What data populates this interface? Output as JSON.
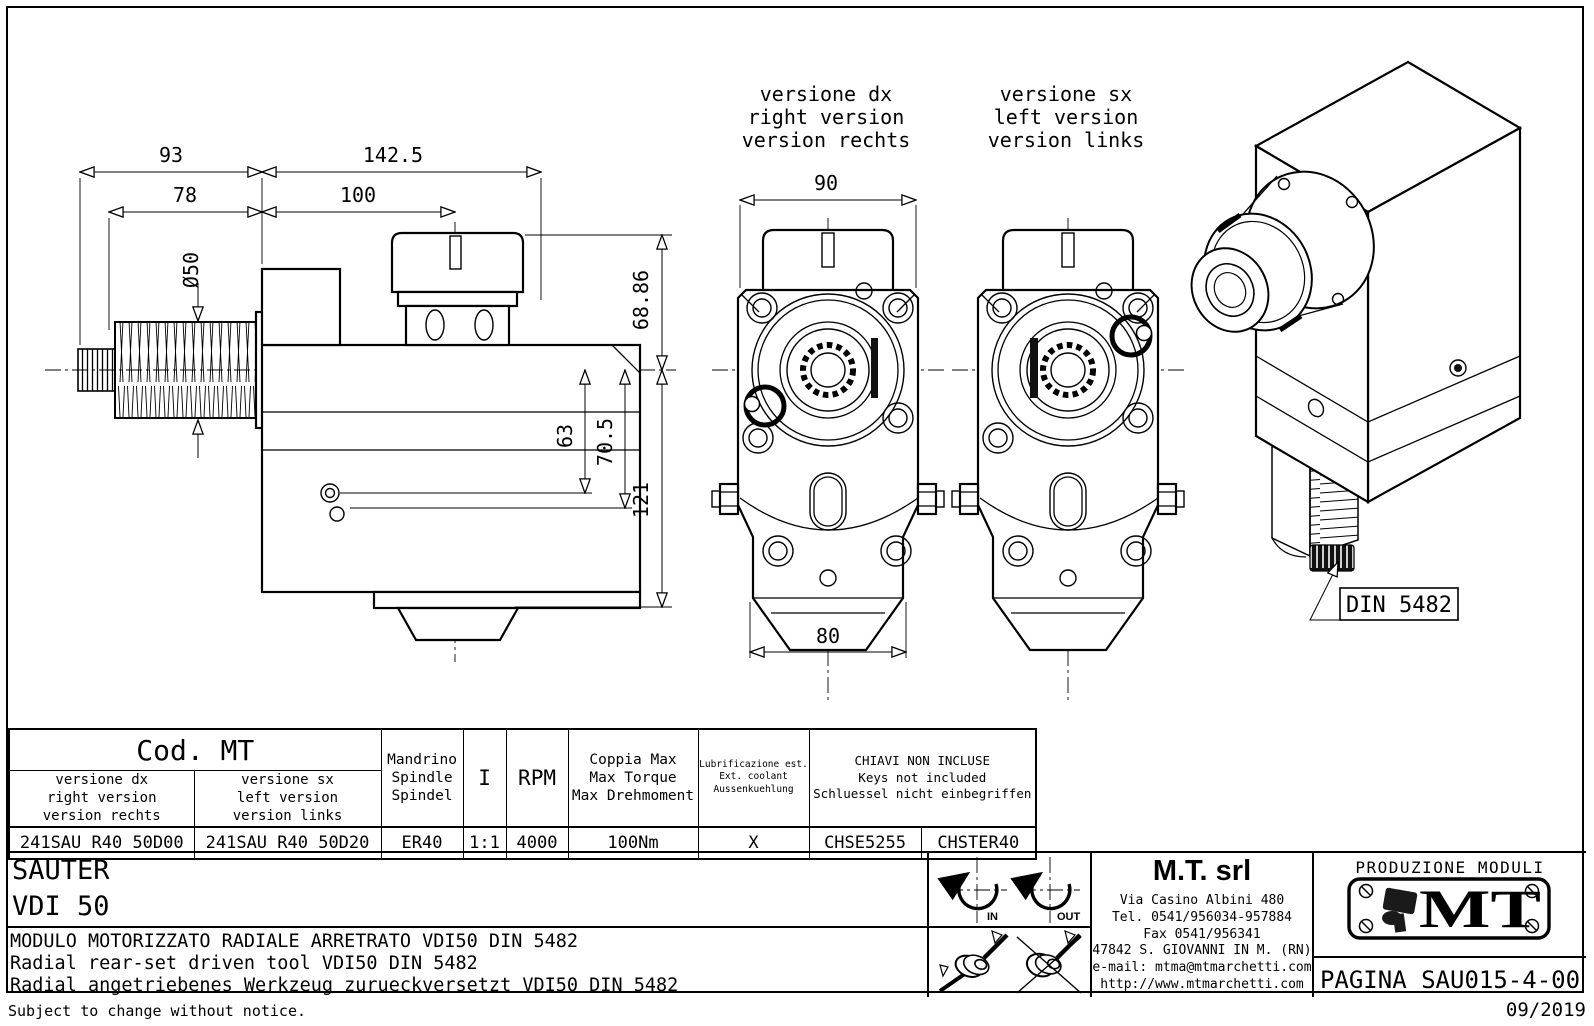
{
  "drawing": {
    "dims": {
      "w93": "93",
      "w1425": "142.5",
      "w78": "78",
      "w100": "100",
      "dia": "Ø50",
      "h6886": "68.86",
      "h63": "63",
      "h705": "70.5",
      "h121": "121",
      "w90": "90",
      "w80": "80"
    },
    "front_dx_label": [
      "versione dx",
      "right version",
      "version rechts"
    ],
    "front_sx_label": [
      "versione sx",
      "left version",
      "version links"
    ],
    "din": "DIN 5482"
  },
  "table": {
    "cod": "Cod. MT",
    "h_spindle": [
      "Mandrino",
      "Spindle",
      "Spindel"
    ],
    "h_ratio": "I",
    "h_rpm": "RPM",
    "h_torque": [
      "Coppia Max",
      "Max Torque",
      "Max Drehmoment"
    ],
    "h_coolant": [
      "Lubrificazione est.",
      "Ext. coolant",
      "Aussenkuehlung"
    ],
    "h_keys": [
      "CHIAVI NON INCLUSE",
      "Keys not included",
      "Schluessel nicht einbegriffen"
    ],
    "sub_dx": [
      "versione dx",
      "right version",
      "version rechts"
    ],
    "sub_sx": [
      "versione sx",
      "left version",
      "version links"
    ],
    "row": [
      "241SAU_R40_50D00",
      "241SAU_R40_50D20",
      "ER40",
      "1:1",
      "4000",
      "100Nm",
      "X",
      "CHSE5255",
      "CHSTER40"
    ]
  },
  "title_block": {
    "brand": "SAUTER",
    "model": "VDI 50",
    "desc": [
      "MODULO MOTORIZZATO RADIALE ARRETRATO VDI50 DIN 5482",
      "Radial rear-set driven tool VDI50 DIN 5482",
      "Radial angetriebenes Werkzeug zurueckversetzt VDI50 DIN 5482"
    ],
    "rot_in": "IN",
    "rot_out": "OUT",
    "company_name": "M.T. srl",
    "company_lines": [
      "Via Casino Albini 480",
      "Tel. 0541/956034-957884",
      "Fax 0541/956341",
      "47842 S. GIOVANNI IN M. (RN)",
      "e-mail: mtma@mtmarchetti.com",
      "http://www.mtmarchetti.com"
    ],
    "production": "PRODUZIONE MODULI ROTANTI",
    "logo": "MT",
    "page": "PAGINA SAU015-4-00"
  },
  "footer": {
    "notice": "Subject to change without notice.",
    "date": "09/2019"
  },
  "colors": {
    "ink": "#000000",
    "paper": "#ffffff"
  }
}
